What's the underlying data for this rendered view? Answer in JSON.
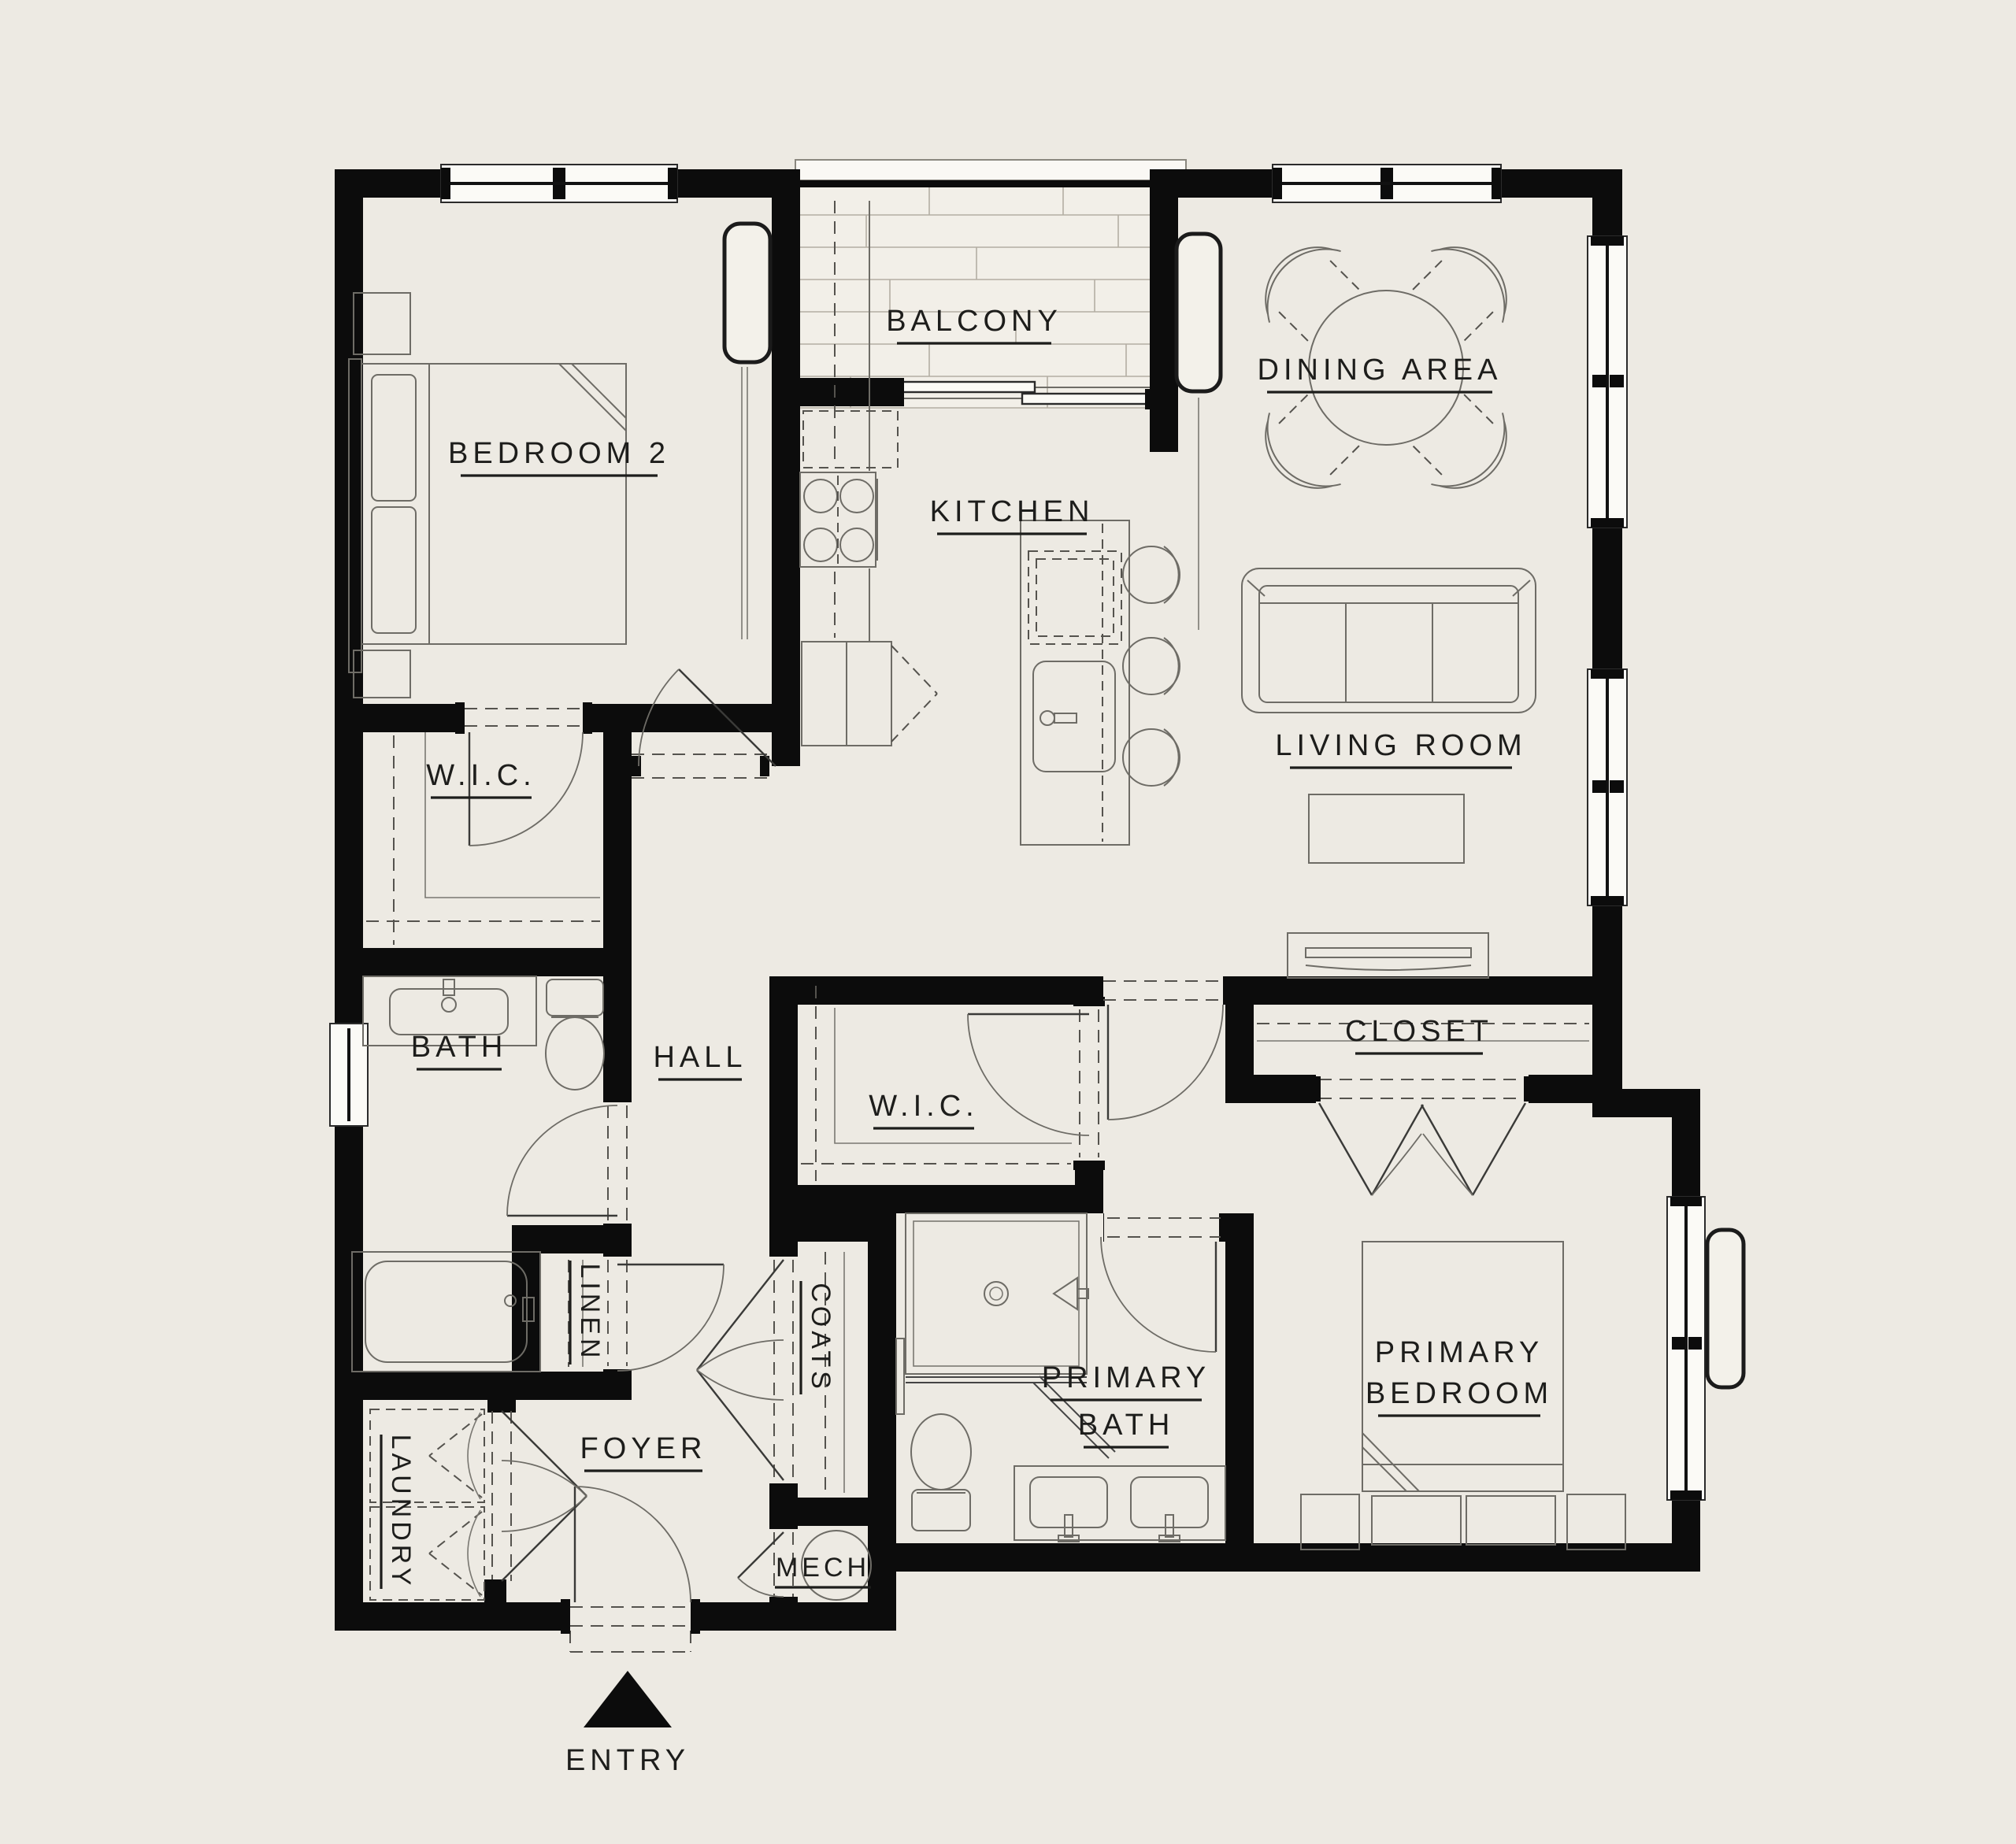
{
  "title": "Apartment floor plan",
  "colors": {
    "background": "#EDEAE3",
    "wall": "#0C0C0C",
    "furniture_line": "#6E6C66",
    "label_text": "#1D1D1B",
    "deck_fill": "#F2EFE8"
  },
  "rooms": {
    "bedroom2": "BEDROOM 2",
    "balcony": "BALCONY",
    "dining": "DINING AREA",
    "kitchen": "KITCHEN",
    "living": "LIVING ROOM",
    "wic1": "W.I.C.",
    "bath": "BATH",
    "hall": "HALL",
    "wic2": "W.I.C.",
    "closet": "CLOSET",
    "linen": "LINEN",
    "coats": "COATS",
    "laundry": "LAUNDRY",
    "foyer": "FOYER",
    "mech": "MECH",
    "primary_bath_line1": "PRIMARY",
    "primary_bath_line2": "BATH",
    "primary_bedroom_line1": "PRIMARY",
    "primary_bedroom_line2": "BEDROOM",
    "entry": "ENTRY"
  }
}
